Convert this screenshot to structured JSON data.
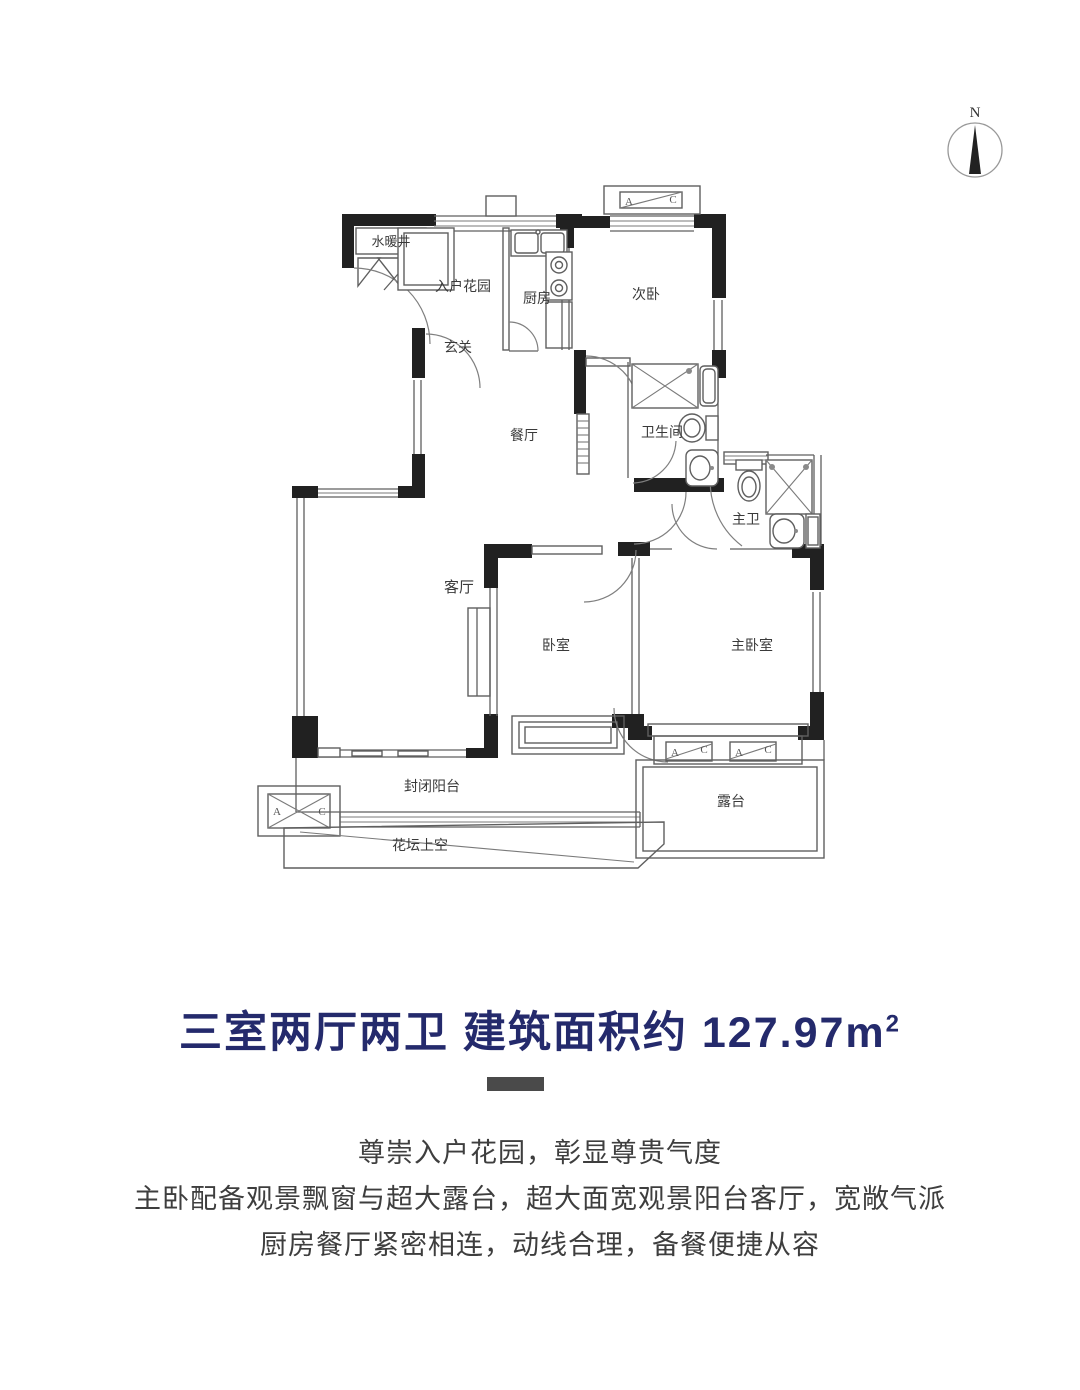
{
  "compass": {
    "north_label": "N"
  },
  "plan": {
    "rooms": {
      "utility_shaft": "水暖井",
      "entry_garden": "入户花园",
      "kitchen": "厨房",
      "second_bedroom": "次卧",
      "foyer": "玄关",
      "dining": "餐厅",
      "bathroom": "卫生间",
      "master_bath": "主卫",
      "living": "客厅",
      "bedroom": "卧室",
      "master_bedroom": "主卧室",
      "enclosed_balcony": "封闭阳台",
      "flower_bed": "花坛上空",
      "terrace": "露台"
    },
    "ac": {
      "a": "A",
      "c": "C"
    }
  },
  "title": {
    "text": "三室两厅两卫 建筑面积约 127.97m",
    "sup": "2",
    "color": "#242a6c"
  },
  "divider_color": "#4a4a4a",
  "description": {
    "lines": [
      "尊崇入户花园，彰显尊贵气度",
      "主卧配备观景飘窗与超大露台，超大面宽观景阳台客厅，宽敞气派",
      "厨房餐厅紧密相连，动线合理，备餐便捷从容"
    ]
  }
}
